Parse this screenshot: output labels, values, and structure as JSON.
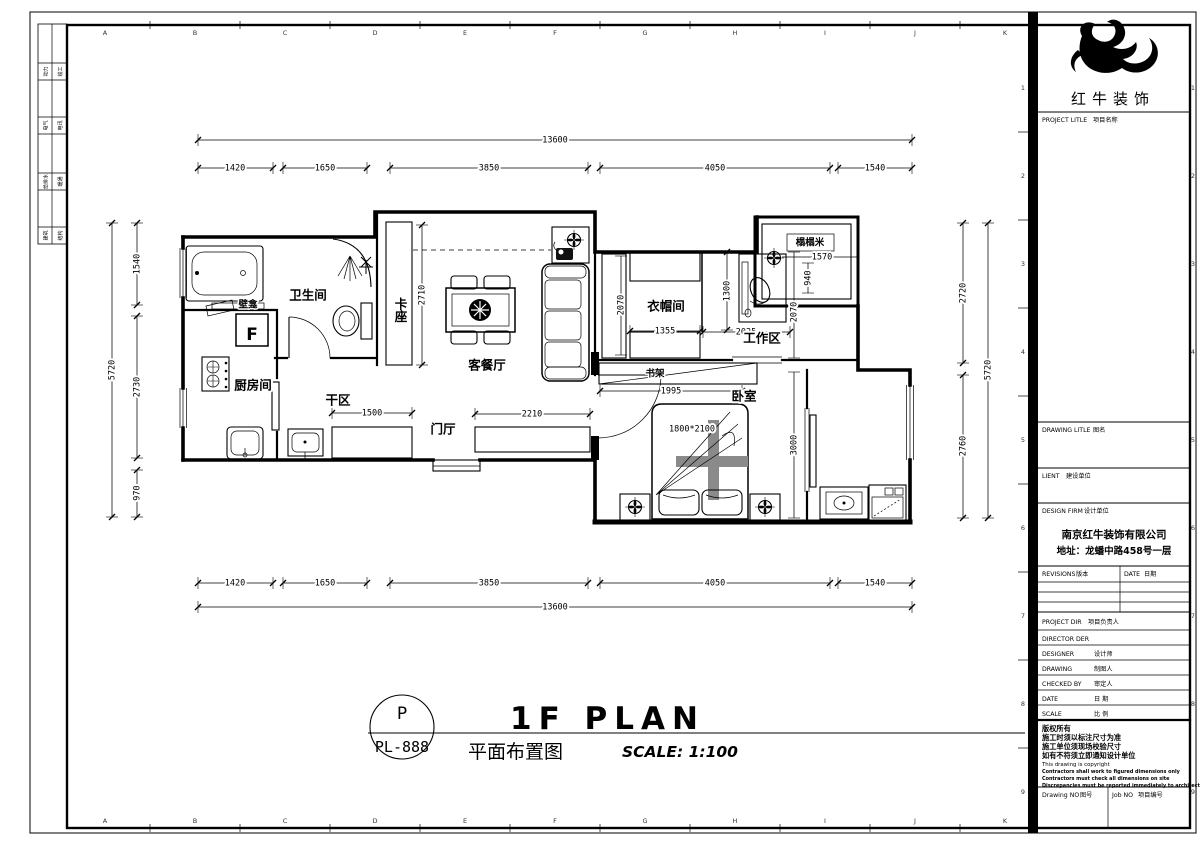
{
  "sheet": {
    "grid_letters": [
      "A",
      "B",
      "C",
      "D",
      "E",
      "F",
      "G",
      "H",
      "I",
      "J",
      "K"
    ],
    "grid_numbers": [
      "1",
      "2",
      "3",
      "4",
      "5",
      "6",
      "7",
      "8",
      "9"
    ],
    "signoff": [
      [
        "动力",
        "竣工"
      ],
      [
        "电气",
        "电讯"
      ],
      [
        "给排水",
        "暖通"
      ],
      [
        "建筑",
        "结构"
      ]
    ]
  },
  "plan": {
    "rooms": {
      "bathroom": "卫生间",
      "niche": "壁龛",
      "kitchen": "厨房间",
      "dry_area": "干区",
      "foyer": "门厅",
      "booth": "卡座",
      "living_dining": "客餐厅",
      "cloakroom": "衣帽间",
      "work_area": "工作区",
      "tatami": "榻榻米",
      "bookshelf": "书架",
      "bedroom": "卧室",
      "fridge": "F",
      "bed_size": "1800*2100"
    },
    "dims": {
      "total": "13600",
      "segs": [
        "1420",
        "1650",
        "3850",
        "4050",
        "1540"
      ],
      "side_total": "5720",
      "left_segs": [
        "1540",
        "2730",
        "970"
      ],
      "right_segs": [
        "2720",
        "2760"
      ],
      "booth_h": "2710",
      "dry_cab": "1500",
      "foyer_cab": "2210",
      "cloak_w": "1355",
      "cloak_d": "2070",
      "desk": "1300",
      "work_w": "2025",
      "work_d": "2070",
      "tatami_w": "1570",
      "tatami_h": "940",
      "shelf": "1995",
      "bed_wall": "3000"
    }
  },
  "title": {
    "code_top": "P",
    "code_bottom": "PL-888",
    "main": "1F PLAN",
    "cn": "平面布置图",
    "scale": "SCALE: 1:100"
  },
  "titleblock": {
    "brand": "红牛装饰",
    "firm_name": "南京红牛装饰有限公司",
    "firm_addr": "地址：龙蟠中路458号一层",
    "rows": {
      "project_title_en": "PROJECT LITLE",
      "project_title_cn": "项目名称",
      "drawing_title_en": "DRAWING LITLE",
      "drawing_title_cn": "图名",
      "client_en": "LIENT",
      "client_cn": "建设单位",
      "firm_en": "DESIGN FIRM",
      "firm_cn": "设计单位",
      "revisions_en": "REVISIONS",
      "revisions_cn": "版本",
      "revdate_en": "DATE",
      "revdate_cn": "日期",
      "project_dir_en": "PROJECT DIR",
      "project_dir_cn": "项目负责人",
      "director_en": "DIRECTOR DER",
      "designer_en": "DESIGNER",
      "designer_cn": "设计师",
      "drawing_en": "DRAWING",
      "drawing_cn": "制图人",
      "checked_en": "CHECKED BY",
      "checked_cn": "审定人",
      "date_en": "DATE",
      "date_cn": "日 期",
      "scale_en": "SCALE",
      "scale_cn": "比 例",
      "drawno_en": "Drawing NO",
      "drawno_cn": "图号",
      "jobno_en": "Job NO",
      "jobno_cn": "项目编号"
    },
    "notes": [
      "版权所有",
      "施工时须以标注尺寸为准",
      "施工单位须现场校验尺寸",
      "如有不符须立即通知设计单位",
      "This drawing is copyright",
      "Contractors shall work to figured dimensions only",
      "Contractors must check all dimensions on site",
      "Discrepancies must be reported immediately to architects"
    ]
  }
}
